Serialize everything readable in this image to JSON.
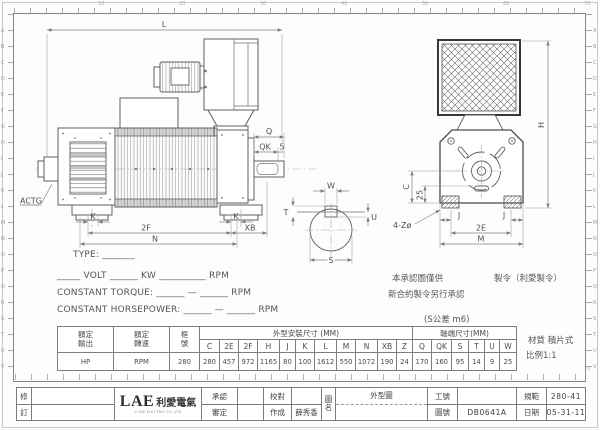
{
  "sheet": {
    "ruler": {
      "side_letters": [
        "A",
        "B",
        "C",
        "D",
        "E",
        "F",
        "G",
        "H",
        "I",
        "J",
        "K",
        "L",
        "M",
        "N",
        "O",
        "P",
        "Q",
        "R",
        "S",
        "T",
        "U",
        "V"
      ],
      "top_numbers": [
        "10",
        "20",
        "30",
        "40",
        "50",
        "60",
        "70"
      ]
    }
  },
  "drawing": {
    "side_view": {
      "dim_l": "L",
      "dim_q": "Q",
      "dim_qk": "QK",
      "dim_5": "5",
      "dim_k_left": "K",
      "dim_k_right": "K",
      "dim_2f": "2F",
      "dim_xb": "XB",
      "dim_n": "N",
      "actg": "ACTG"
    },
    "end_view": {
      "dim_h": "H",
      "dim_c": "C",
      "dim_25": "25",
      "holes": "4-Zø",
      "dim_j_left": "J",
      "dim_j_right": "J",
      "dim_2e": "2E",
      "dim_m": "M"
    },
    "shaft_section": {
      "dim_w": "W",
      "dim_t": "T",
      "dim_u": "U",
      "dim_s": "S"
    }
  },
  "spec": {
    "type_line": "TYPE: _______",
    "rating_line": "_____ VOLT ______ KW __________ RPM",
    "torque_line": "CONSTANT TORQUE: ______ — ______ RPM",
    "horsepower_line": "CONSTANT HORSEPOWER: ______ — ______ RPM"
  },
  "notes": {
    "line1_left": "本承認圖僅供",
    "line1_right": "製令（利愛製令）",
    "line2": "新合約製令另行承認",
    "tolerance": "(S公差 m6)"
  },
  "dim_table": {
    "rated_output": {
      "label_top": "額定",
      "label_bottom": "輸出",
      "value": "HP"
    },
    "rated_speed": {
      "label_top": "額定",
      "label_bottom": "轉速",
      "value": "RPM"
    },
    "frame": {
      "label_top": "框",
      "label_bottom": "號",
      "value": "280"
    },
    "outline_header": "外型安裝尺寸 (MM)",
    "outline_cols": [
      "C",
      "2E",
      "2F",
      "H",
      "J",
      "K",
      "L",
      "M",
      "N",
      "XB",
      "Z"
    ],
    "outline_vals": [
      "280",
      "457",
      "972",
      "1165",
      "80",
      "100",
      "1612",
      "550",
      "1072",
      "190",
      "24"
    ],
    "shaft_header": "軸端尺寸(MM)",
    "shaft_cols": [
      "Q",
      "QK",
      "S",
      "T",
      "U",
      "W"
    ],
    "shaft_vals": [
      "170",
      "160",
      "95",
      "14",
      "9",
      "25"
    ]
  },
  "side_notes": {
    "material": "材質 積片式",
    "scale": "比例1:1"
  },
  "titleblock": {
    "revise_top": "修",
    "revise_bottom": "訂",
    "logo_text": "LAE",
    "logo_cn": "利愛電氣",
    "logo_sub": "LI AIE ELECTRIC CO.,LTD",
    "approved_label": "承認",
    "reviewed_label": "審定",
    "checked_label": "校對",
    "drawn_label": "作成",
    "drawn_by": "薛秀香",
    "name_label_top": "圖",
    "name_label_bottom": "名",
    "drawing_name": "外型圖",
    "work_no_label": "工號",
    "dwg_no_label": "圖號",
    "dwg_no": "DB0641A",
    "spec_label": "規範",
    "spec_value": "280-41",
    "date_label": "日期",
    "date_value": "05-31-11"
  }
}
